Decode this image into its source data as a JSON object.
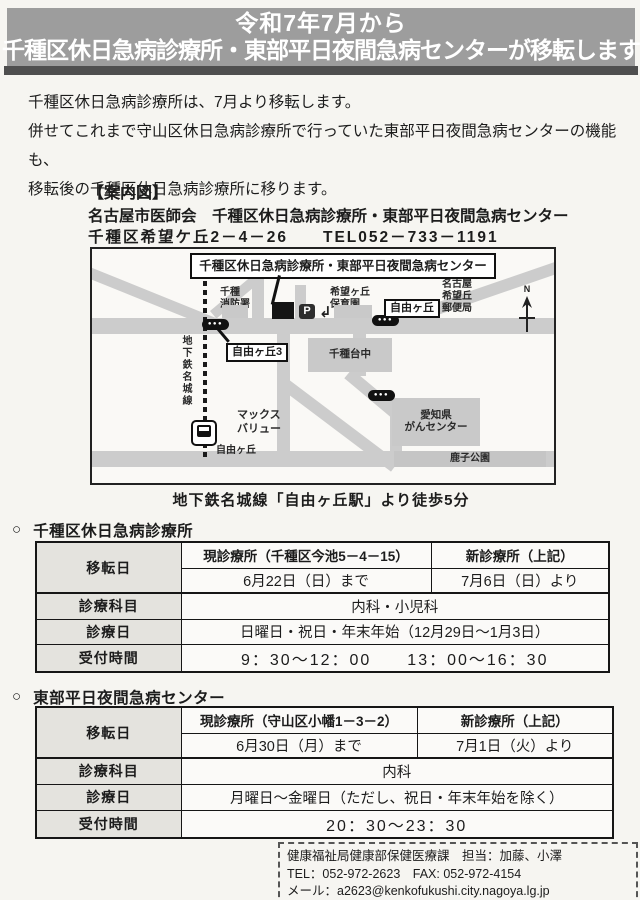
{
  "colors": {
    "banner_bg": "#9d9d9d",
    "banner_underline": "#4f4f4f",
    "table_label_bg": "#e4e3de",
    "road_gray": "#cccccc",
    "building_gray": "#c9c9c9",
    "ink": "#1c1c1c",
    "paper": "#f6f5f1"
  },
  "banner": {
    "line1": "令和7年7月から",
    "line2": "千種区休日急病診療所・東部平日夜間急病センターが移転します"
  },
  "intro": {
    "text": "千種区休日急病診療所は、7月より移転します。\n併せてこれまで守山区休日急病診療所で行っていた東部平日夜間急病センターの機能も、\n移転後の千種区休日急病診療所に移ります。"
  },
  "guide": {
    "heading": "【案内図】",
    "org": "名古屋市医師会　千種区休日急病診療所・東部平日夜間急病センター",
    "address": "千種区希望ケ丘2－4－26　　TEL052－733－1191"
  },
  "map": {
    "title": "千種区休日急病診療所・東部平日夜間急病センター",
    "subway_line": "地下鉄名城線",
    "fire_station": "千種\n消防署",
    "nursery": "希望ヶ丘\n保育園",
    "post_office": "名古屋\n希望丘\n郵便局",
    "bus_stop_dots": "●●●",
    "bus_callout_jiyugaoka3": "自由ヶ丘3",
    "bus_callout_jiyugaoka": "自由ヶ丘",
    "junior_high": "千種台中",
    "supermarket": "マックス\nバリュー",
    "station_label": "自由ヶ丘",
    "cancer_center": "愛知県\nがんセンター",
    "park": "鹿子公園",
    "parking_label": "P",
    "entrance_arrow": "↲",
    "compass_n": "N",
    "caption": "地下鉄名城線「自由ヶ丘駅」より徒歩5分"
  },
  "section_chikusa": {
    "bullet": "○",
    "heading": "千種区休日急病診療所",
    "table": {
      "label_move": "移転日",
      "label_dept": "診療科目",
      "label_days": "診療日",
      "label_hours": "受付時間",
      "current_header": "現診療所（千種区今池5－4－15）",
      "new_header": "新診療所（上記）",
      "current_until": "6月22日（日）まで",
      "new_from": "7月6日（日）より",
      "dept": "内科・小児科",
      "days": "日曜日・祝日・年末年始（12月29日～1月3日）",
      "hours": "9：30～12：00　　13：00～16：30"
    }
  },
  "section_tobu": {
    "bullet": "○",
    "heading": "東部平日夜間急病センター",
    "table": {
      "label_move": "移転日",
      "label_dept": "診療科目",
      "label_days": "診療日",
      "label_hours": "受付時間",
      "current_header": "現診療所（守山区小幡1－3－2）",
      "new_header": "新診療所（上記）",
      "current_until": "6月30日（月）まで",
      "new_from": "7月1日（火）より",
      "dept": "内科",
      "days": "月曜日～金曜日（ただし、祝日・年末年始を除く）",
      "hours": "20：30～23：30"
    }
  },
  "contact": {
    "line1": "健康福祉局健康部保健医療課　担当：加藤、小澤",
    "line2": "TEL：052-972-2623　FAX: 052-972-4154",
    "line3": "メール：a2623@kenkofukushi.city.nagoya.lg.jp"
  }
}
